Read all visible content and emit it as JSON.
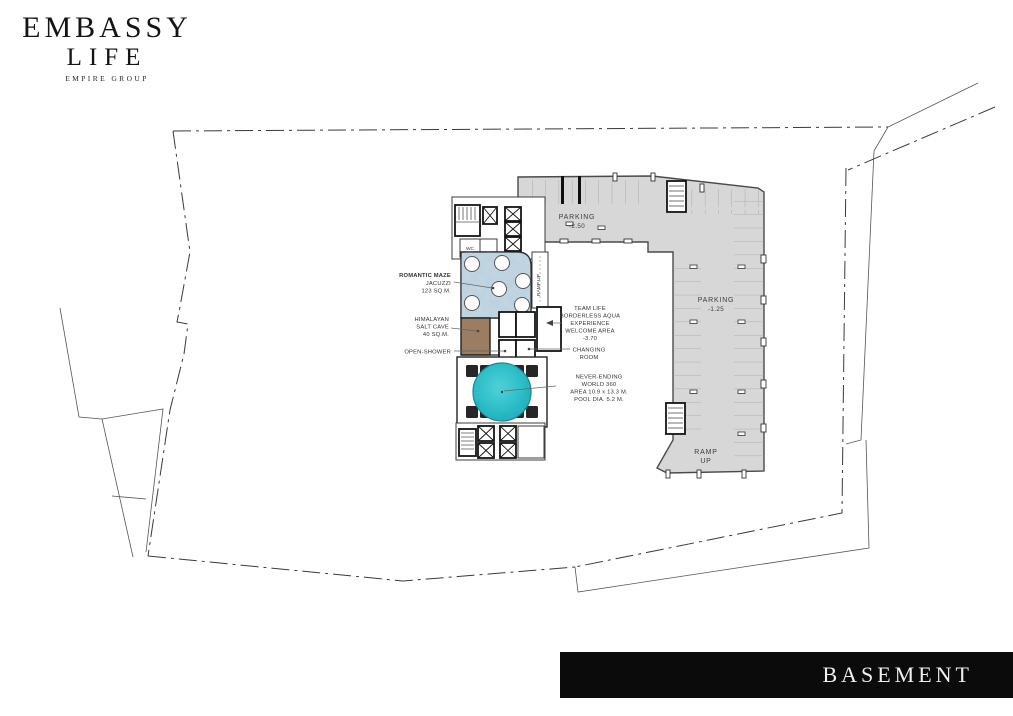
{
  "logo": {
    "brand_top": "EMBASSY",
    "brand_bottom": "LIFE",
    "group": "EMPIRE GROUP"
  },
  "floor_bar": {
    "label": "BASEMENT"
  },
  "colors": {
    "parking": "#d7d7d7",
    "marble": "#c4d8e4",
    "salt_cave": "#9b7d62",
    "pool": "#29c0cc",
    "boundary": "#3a3a3a",
    "bar_bg": "#0b0b0b"
  },
  "plan": {
    "parking_top": {
      "title": "PARKING",
      "level": "-2.50"
    },
    "parking_right": {
      "title": "PARKING",
      "level": "-1.25"
    },
    "ramp": {
      "line1": "RAMP",
      "line2": "UP"
    },
    "ramp_corridor": "RAMP UP",
    "wc": "WC",
    "jacuzzi": {
      "l1": "ROMANTIC MAZE",
      "l2": "JACUZZI",
      "l3": "123 SQ.M."
    },
    "salt_cave": {
      "l1": "HIMALAYAN",
      "l2": "SALT CAVE",
      "l3": "40 SQ.M."
    },
    "open_shower": "OPEN-SHOWER",
    "welcome": {
      "l1": "TEAM LIFE",
      "l2": "BORDERLESS AQUA",
      "l3": "EXPERIENCE",
      "l4": "WELCOME AREA",
      "l5": "-3.70"
    },
    "changing": {
      "l1": "CHANGING",
      "l2": "ROOM"
    },
    "pool": {
      "l1": "NEVER-ENDING",
      "l2": "WORLD 360",
      "l3": "AREA 10.9 x 13.3 M.",
      "l4": "POOL DIA. 5.2 M."
    }
  }
}
